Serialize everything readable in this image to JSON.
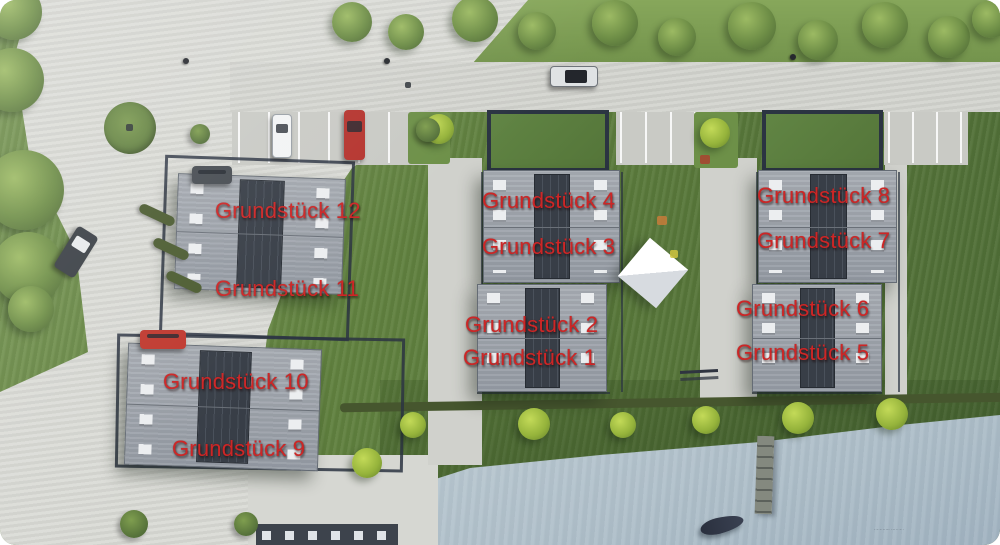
{
  "image": {
    "type": "aerial-site-plan-rendering",
    "label_color": "#cd2626"
  },
  "plot_labels": [
    {
      "id": "grundstueck-12",
      "text": "Grundstück 12",
      "x": 215,
      "y": 199
    },
    {
      "id": "grundstueck-11",
      "text": "Grundstück 11",
      "x": 215,
      "y": 277
    },
    {
      "id": "grundstueck-10",
      "text": "Grundstück 10",
      "x": 163,
      "y": 370
    },
    {
      "id": "grundstueck-9",
      "text": "Grundstück 9",
      "x": 172,
      "y": 437
    },
    {
      "id": "grundstueck-4",
      "text": "Grundstück 4",
      "x": 482,
      "y": 189
    },
    {
      "id": "grundstueck-3",
      "text": "Grundstück 3",
      "x": 482,
      "y": 235
    },
    {
      "id": "grundstueck-2",
      "text": "Grundstück 2",
      "x": 465,
      "y": 313
    },
    {
      "id": "grundstueck-1",
      "text": "Grundstück 1",
      "x": 463,
      "y": 346
    },
    {
      "id": "grundstueck-8",
      "text": "Grundstück 8",
      "x": 757,
      "y": 184
    },
    {
      "id": "grundstueck-7",
      "text": "Grundstück 7",
      "x": 757,
      "y": 229
    },
    {
      "id": "grundstueck-6",
      "text": "Grundstück 6",
      "x": 736,
      "y": 297
    },
    {
      "id": "grundstueck-5",
      "text": "Grundstück 5",
      "x": 736,
      "y": 341
    }
  ],
  "watermark": {
    "line1": "· ··· ····· ····· ···",
    "line2": "··· ······· ···· ··"
  }
}
